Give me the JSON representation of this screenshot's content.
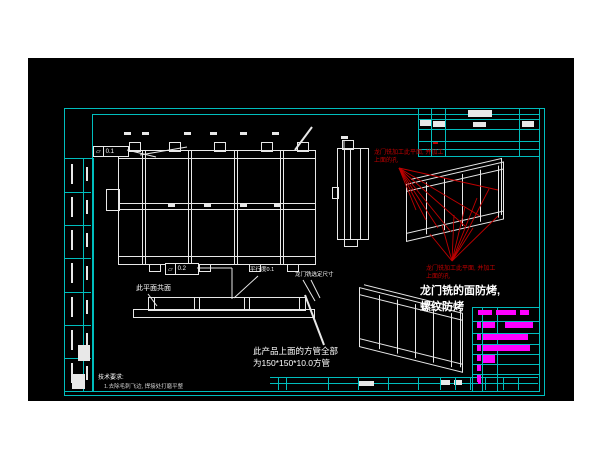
{
  "drawing": {
    "notes": {
      "coplanar": "此平面共面",
      "parallelism": "平行度0.1",
      "gantry_fit": "龙门铣选定尺寸",
      "tube_spec_1": "此产品上面的方管全部",
      "tube_spec_2": "为150*150*10.0方管",
      "milling_1": "龙门铣的面防烤,",
      "milling_2": "螺纹防烤",
      "red_top_1": "龙门铣加工此平面, 并加工",
      "red_top_2": "上面的孔",
      "red_bottom_1": "龙门铣加工此平面, 并加工",
      "red_bottom_2": "上面的孔",
      "tech_title": "技术要求:",
      "tech_item_1": "1.去除毛刺飞边, 焊接处打磨平整"
    },
    "gdt": {
      "flatness_plan": {
        "symbol": "▱",
        "value": "0.1"
      },
      "flatness_beam": {
        "symbol": "▱",
        "value": "0.2"
      }
    },
    "colors": {
      "frame": "#00bdbd",
      "line": "#e8e8e8",
      "accent": "#ff00ff",
      "warn": "#c00000",
      "bg": "#000000",
      "page": "#ffffff"
    },
    "geometry": {
      "red_leaders": [
        [
          371,
          110,
          388,
          152
        ],
        [
          371,
          110,
          398,
          162
        ],
        [
          371,
          110,
          410,
          170
        ],
        [
          371,
          110,
          423,
          174
        ],
        [
          371,
          110,
          437,
          168
        ],
        [
          371,
          110,
          452,
          158
        ],
        [
          371,
          110,
          470,
          132
        ],
        [
          424,
          203,
          402,
          176
        ],
        [
          424,
          203,
          414,
          167
        ],
        [
          424,
          203,
          426,
          157
        ],
        [
          424,
          203,
          437,
          149
        ],
        [
          424,
          203,
          449,
          140
        ],
        [
          424,
          203,
          461,
          131
        ],
        [
          424,
          203,
          470,
          158
        ],
        [
          424,
          203,
          445,
          170
        ]
      ],
      "white_lines": [
        [
          99,
          92,
          128,
          99,
          1
        ],
        [
          169,
          210,
          204,
          210,
          1
        ],
        [
          204,
          210,
          204,
          241,
          1
        ],
        [
          120,
          236,
          129,
          248,
          1
        ],
        [
          230,
          218,
          206,
          240,
          1
        ],
        [
          275,
          222,
          287,
          243,
          1
        ],
        [
          283,
          222,
          292,
          240,
          1
        ],
        [
          112,
          97,
          159,
          89,
          1
        ],
        [
          267,
          92,
          284,
          69,
          2
        ],
        [
          277,
          237,
          296,
          287,
          2
        ],
        [
          316,
          82,
          316,
          90,
          1
        ]
      ],
      "blocks": [
        {
          "x": 440,
          "y": 52,
          "w": 24,
          "h": 7,
          "c": "w"
        },
        {
          "x": 392,
          "y": 62,
          "w": 11,
          "h": 6,
          "c": "w"
        },
        {
          "x": 405,
          "y": 63,
          "w": 12,
          "h": 6,
          "c": "w"
        },
        {
          "x": 445,
          "y": 64,
          "w": 13,
          "h": 5,
          "c": "w"
        },
        {
          "x": 494,
          "y": 63,
          "w": 12,
          "h": 6,
          "c": "w"
        },
        {
          "x": 405,
          "y": 84,
          "w": 5,
          "h": 2,
          "c": "r"
        },
        {
          "x": 50,
          "y": 287,
          "w": 12,
          "h": 16,
          "c": "w"
        },
        {
          "x": 44,
          "y": 316,
          "w": 13,
          "h": 15,
          "c": "w"
        },
        {
          "x": 330,
          "y": 323,
          "w": 16,
          "h": 5,
          "c": "w"
        },
        {
          "x": 412,
          "y": 322,
          "w": 10,
          "h": 5,
          "c": "w"
        },
        {
          "x": 426,
          "y": 322,
          "w": 8,
          "h": 5,
          "c": "w"
        },
        {
          "x": 450,
          "y": 321,
          "w": 3,
          "h": 5,
          "c": "m"
        }
      ],
      "dim_marks": [
        [
          96,
          74
        ],
        [
          114,
          74
        ],
        [
          156,
          74
        ],
        [
          182,
          74
        ],
        [
          212,
          74
        ],
        [
          244,
          74
        ],
        [
          313,
          78
        ],
        [
          140,
          146
        ],
        [
          176,
          146
        ],
        [
          212,
          146
        ],
        [
          246,
          146
        ]
      ],
      "magenta_bars": [
        [
          450,
          252,
          14,
          5
        ],
        [
          468,
          252,
          20,
          5
        ],
        [
          492,
          252,
          9,
          5
        ],
        [
          449,
          264,
          4,
          6
        ],
        [
          455,
          264,
          12,
          6
        ],
        [
          477,
          264,
          28,
          6
        ],
        [
          449,
          276,
          4,
          6
        ],
        [
          455,
          276,
          45,
          6
        ],
        [
          449,
          287,
          4,
          6
        ],
        [
          455,
          287,
          47,
          6
        ],
        [
          449,
          297,
          4,
          6
        ],
        [
          455,
          297,
          12,
          8
        ],
        [
          449,
          307,
          4,
          6
        ],
        [
          449,
          317,
          4,
          7
        ]
      ],
      "left_strip": {
        "x": 36,
        "y": 100,
        "w": 28,
        "h": 232,
        "rows": 7
      },
      "bottom_dividers": [
        250,
        258,
        300,
        330,
        360,
        390,
        412,
        427,
        442,
        457,
        475,
        490
      ],
      "iso_posts": [
        19,
        37,
        55,
        73,
        91
      ],
      "iso_cells": [
        [
          4,
          9,
          13,
          37
        ],
        [
          22,
          9,
          13,
          37
        ],
        [
          40,
          9,
          13,
          37
        ],
        [
          58,
          9,
          13,
          37
        ],
        [
          76,
          9,
          14,
          37
        ]
      ],
      "plan_posts": [
        23,
        69,
        115,
        161
      ],
      "plan_cells": [
        [
          30,
          13,
          34,
          37
        ],
        [
          76,
          13,
          34,
          37
        ],
        [
          122,
          13,
          34,
          37
        ],
        [
          168,
          13,
          24,
          37
        ],
        [
          30,
          62,
          34,
          37
        ],
        [
          76,
          62,
          34,
          37
        ],
        [
          122,
          62,
          34,
          37
        ],
        [
          168,
          62,
          24,
          37
        ]
      ]
    }
  }
}
